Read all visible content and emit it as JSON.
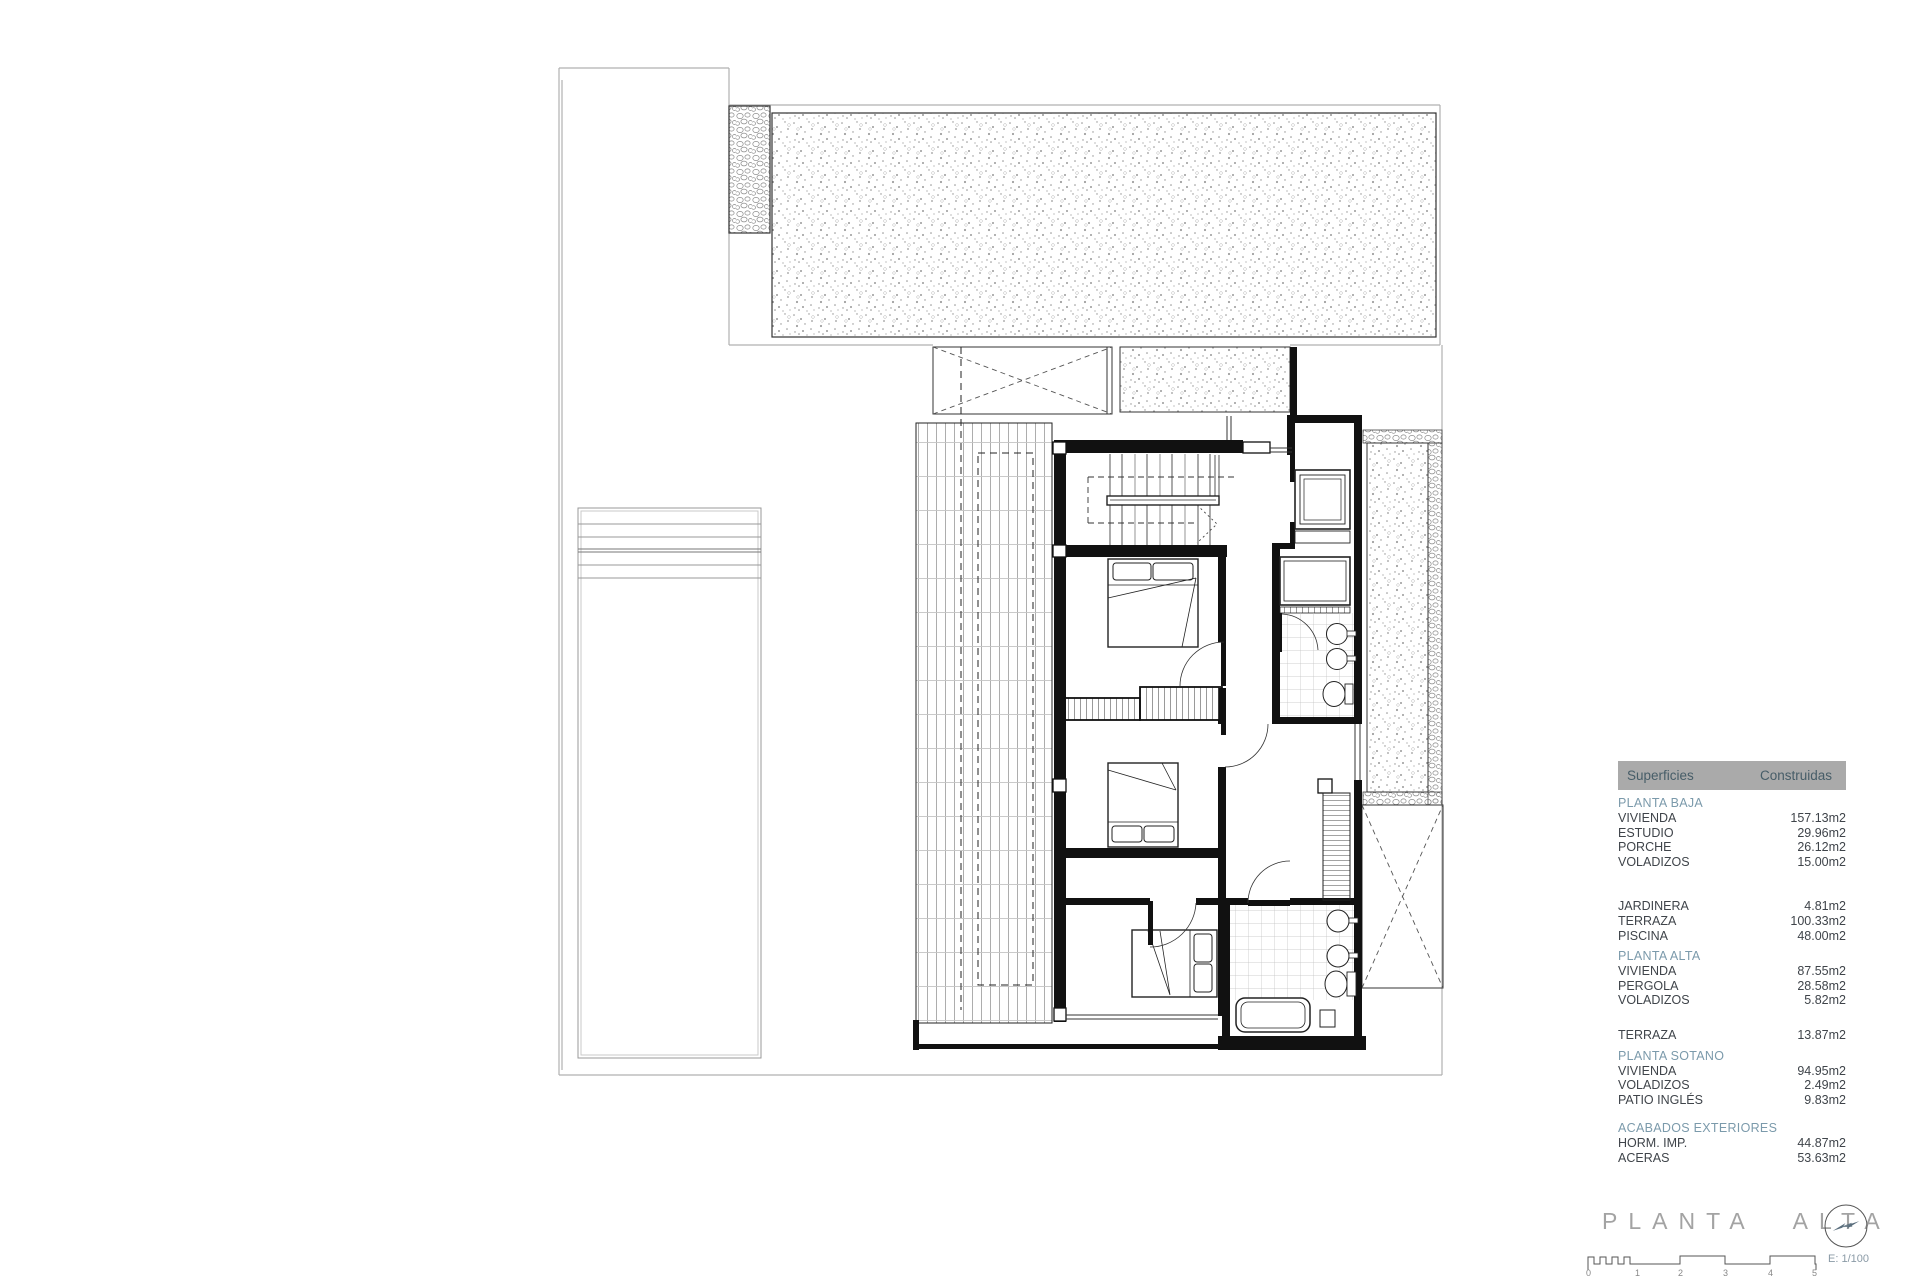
{
  "table": {
    "header": {
      "left": "Superficies",
      "right": "Construidas"
    },
    "sections": [
      {
        "title": "PLANTA BAJA",
        "rows": [
          {
            "label": "VIVIENDA",
            "value": "157.13m2"
          },
          {
            "label": "ESTUDIO",
            "value": "29.96m2"
          },
          {
            "label": "PORCHE",
            "value": "26.12m2"
          },
          {
            "label": "VOLADIZOS",
            "value": "15.00m2"
          }
        ]
      },
      {
        "title": "",
        "rows": [
          {
            "label": "JARDINERA",
            "value": "4.81m2"
          },
          {
            "label": "TERRAZA",
            "value": "100.33m2"
          },
          {
            "label": "PISCINA",
            "value": "48.00m2"
          }
        ]
      },
      {
        "title": "PLANTA ALTA",
        "rows": [
          {
            "label": "VIVIENDA",
            "value": "87.55m2"
          },
          {
            "label": "PERGOLA",
            "value": "28.58m2"
          },
          {
            "label": "VOLADIZOS",
            "value": "5.82m2"
          }
        ]
      },
      {
        "title": "",
        "rows": [
          {
            "label": "TERRAZA",
            "value": "13.87m2"
          }
        ]
      },
      {
        "title": "PLANTA SOTANO",
        "rows": [
          {
            "label": "VIVIENDA",
            "value": "94.95m2"
          },
          {
            "label": "VOLADIZOS",
            "value": "2.49m2"
          },
          {
            "label": "PATIO INGLÉS",
            "value": "9.83m2"
          }
        ]
      },
      {
        "title": "ACABADOS EXTERIORES",
        "rows": [
          {
            "label": "HORM. IMP.",
            "value": "44.87m2"
          },
          {
            "label": "ACERAS",
            "value": "53.63m2"
          }
        ]
      }
    ]
  },
  "titleblock": {
    "title": "PLANTA ALTA",
    "scale_label": "E: 1/100",
    "scale_ticks": [
      "0",
      "1",
      "2",
      "3",
      "4",
      "5"
    ],
    "north_icon": "north-arrow-icon"
  },
  "colors": {
    "section_header": "#7b9aab",
    "header_bar_bg": "#aaaaaa",
    "header_text": "#475d68",
    "body_text": "#3f444a",
    "title_gray": "#a3a3a3"
  }
}
